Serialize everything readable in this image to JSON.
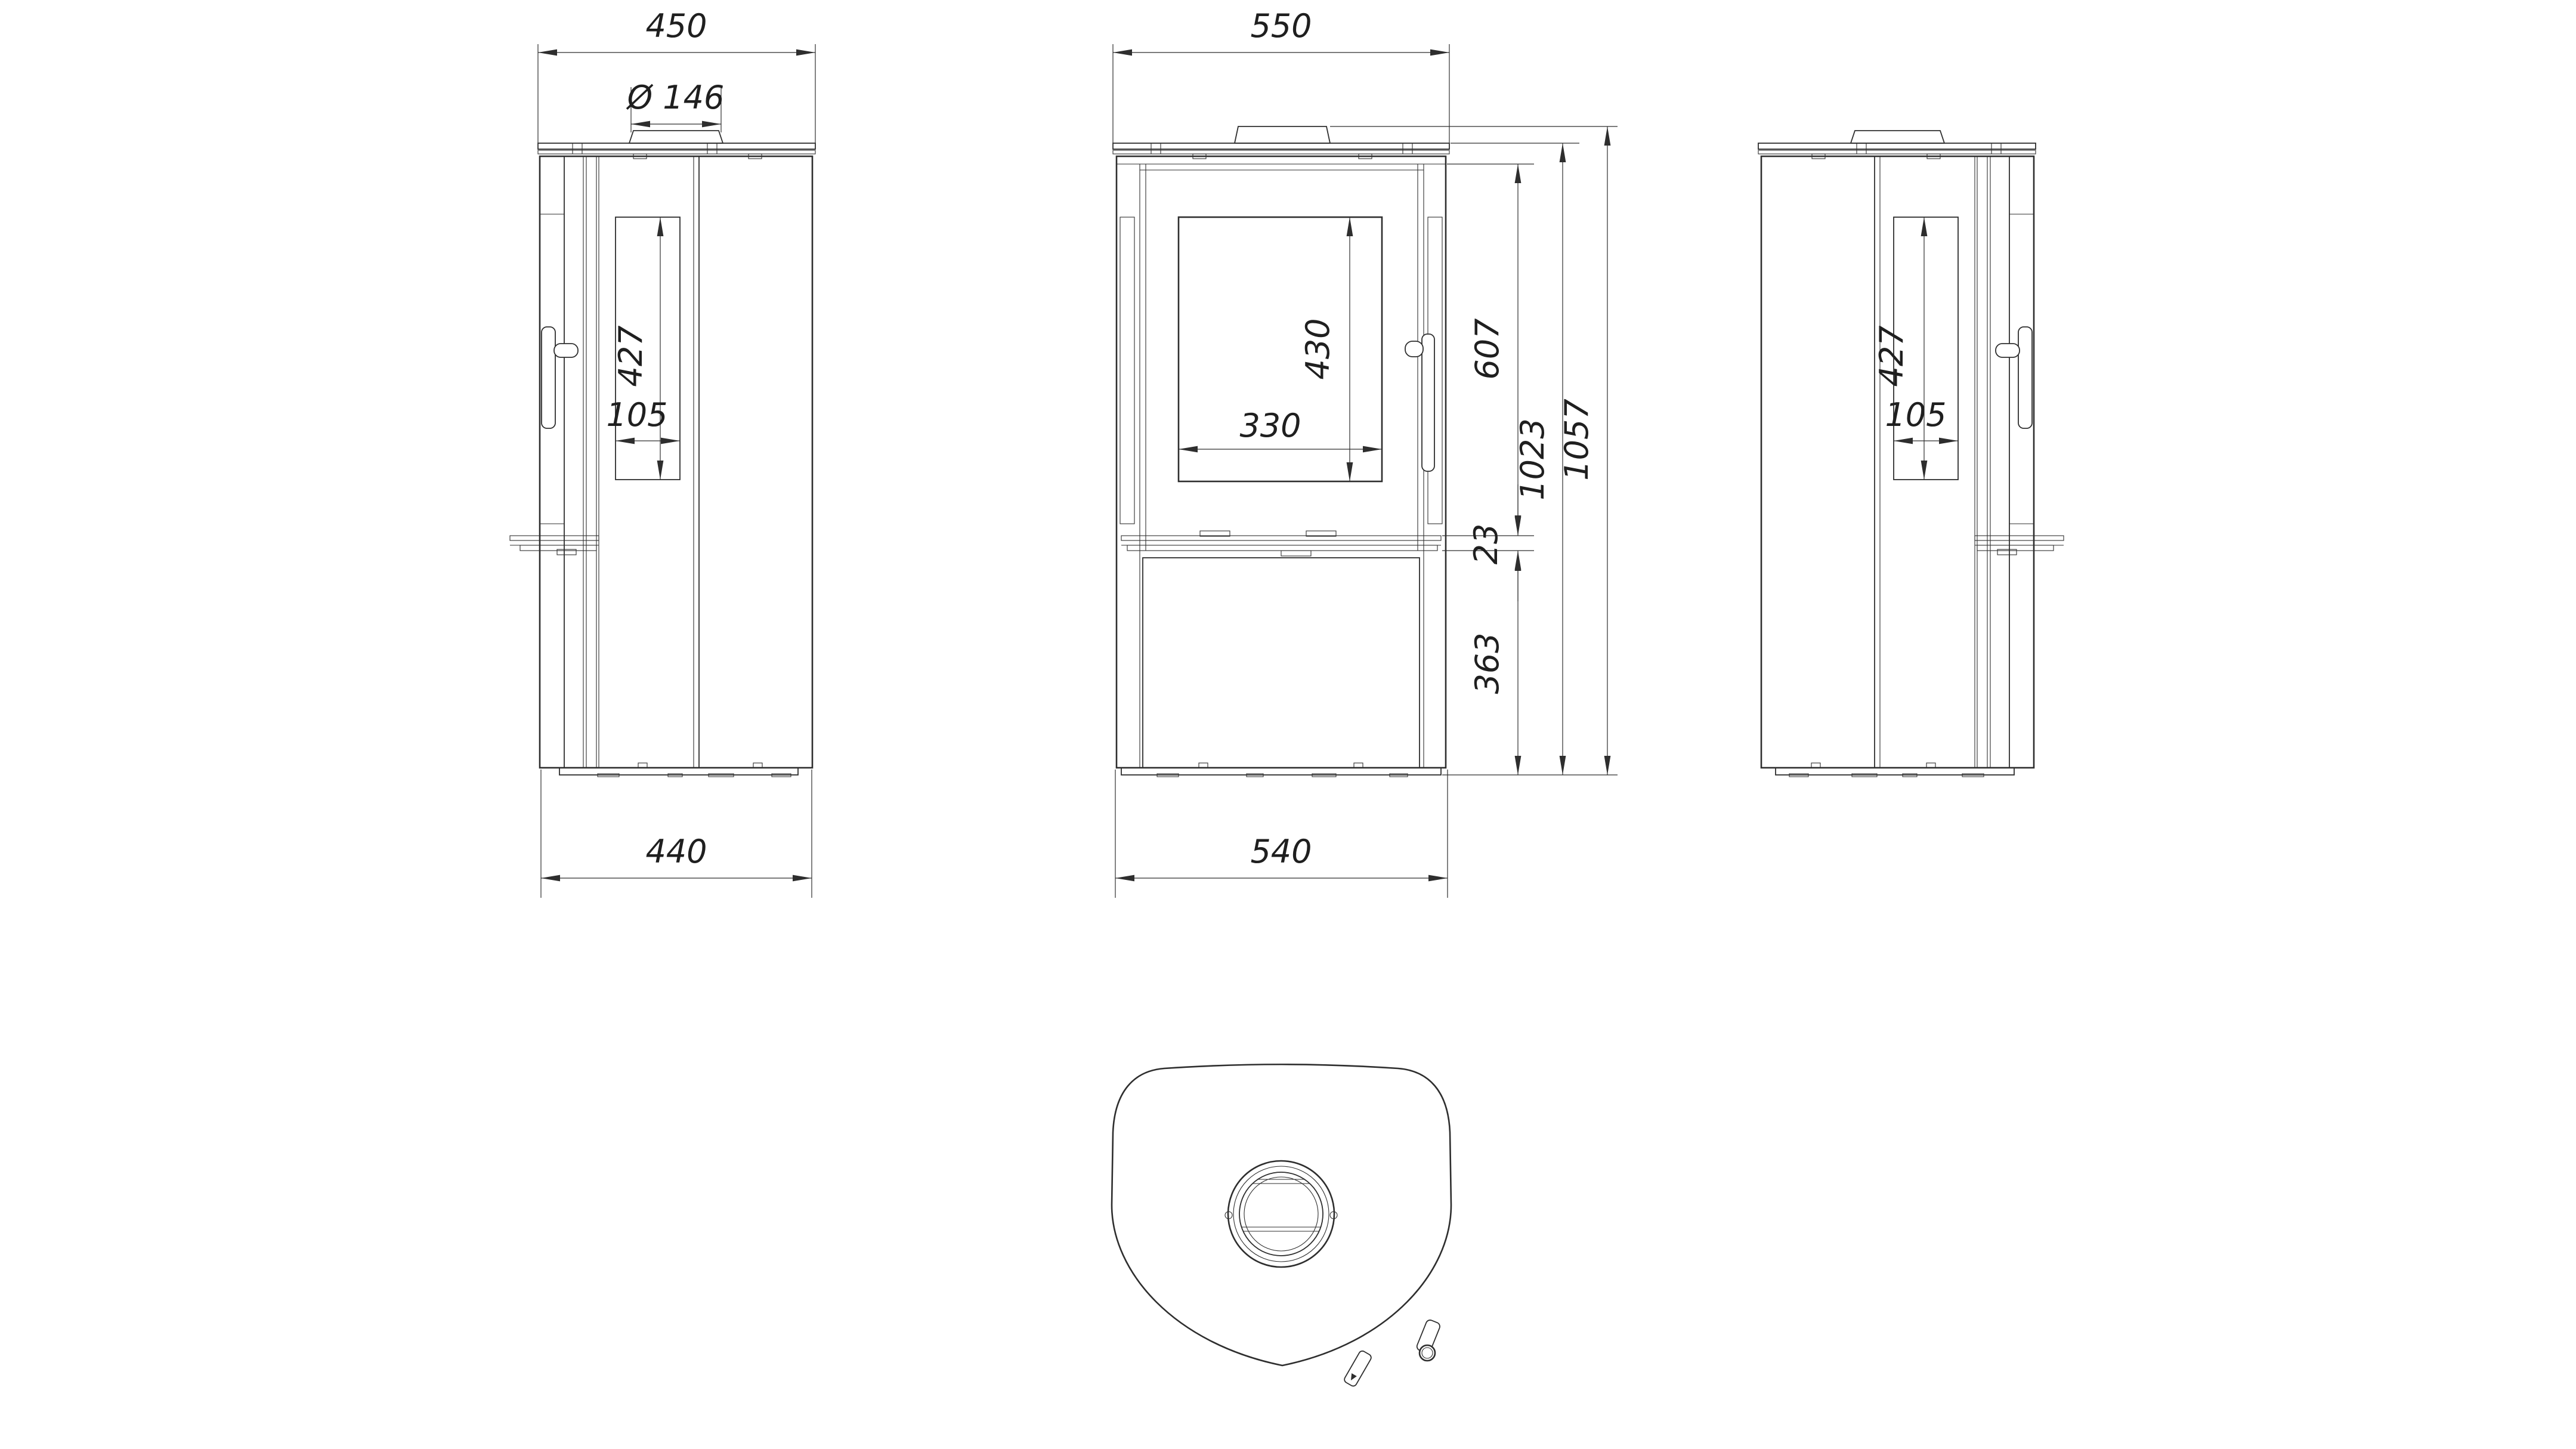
{
  "drawing": {
    "type": "technical-dimension-drawing",
    "subject": "free-standing wood stove, four orthographic views",
    "line_color": "#2e2e2e",
    "background": "#ffffff",
    "views": {
      "side_left": {
        "label": "left side view",
        "dims": {
          "depth_top": "450",
          "flue_diameter": "Ø 146",
          "glass_height": "427",
          "glass_width": "105",
          "depth_bottom": "440"
        }
      },
      "front": {
        "label": "front view",
        "dims": {
          "width_top": "550",
          "glass_height": "430",
          "glass_width": "330",
          "door_height": "607",
          "lip_height": "23",
          "lower_height": "363",
          "body_height": "1023",
          "total_height": "1057",
          "width_bottom": "540"
        }
      },
      "side_right": {
        "label": "right side view",
        "dims": {
          "glass_height": "427",
          "glass_width": "105"
        }
      },
      "top": {
        "label": "top view"
      }
    }
  }
}
